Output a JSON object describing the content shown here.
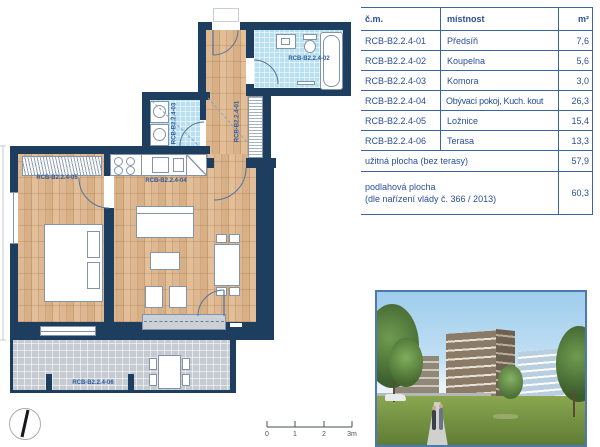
{
  "table": {
    "headers": {
      "code": "č.m.",
      "room": "místnost",
      "area": "m²"
    },
    "rows": [
      {
        "code": "RCB-B2.2.4-01",
        "room": "Předsíň",
        "area": "7,6"
      },
      {
        "code": "RCB-B2.2.4-02",
        "room": "Koupelna",
        "area": "5,6"
      },
      {
        "code": "RCB-B2.2.4-03",
        "room": "Komora",
        "area": "3,0"
      },
      {
        "code": "RCB-B2.2.4-04",
        "room": "Obývací pokoj, Kuch. kout",
        "area": "26,3"
      },
      {
        "code": "RCB-B2.2.4-05",
        "room": "Ložnice",
        "area": "15,4"
      },
      {
        "code": "RCB-B2.2.4-06",
        "room": "Terasa",
        "area": "13,3"
      }
    ],
    "summary1": {
      "label": "užitná plocha (bez terasy)",
      "area": "57,9"
    },
    "summary2": {
      "label": "podlahová plocha",
      "label2": "(dle nařízení vlády č. 366 / 2013)",
      "area": "60,3"
    }
  },
  "plan": {
    "labels": {
      "hall": "RCB-B2.2.4-01",
      "bath": "RCB-B2.2.4-02",
      "storage": "RCB-B2.2.4-03",
      "living": "RCB-B2.2.4-04",
      "bedroom": "RCB-B2.2.4-05",
      "terrace": "RCB-B2.2.4-06"
    },
    "scale_ticks": [
      "0",
      "1",
      "2",
      "3m"
    ]
  },
  "icons": {
    "compass": "north-arrow-icon"
  },
  "colors": {
    "wall": "#1d3e5f",
    "wood_floor": "#d9b38c",
    "bath_floor": "#b9e0f0",
    "terrace_floor": "#c6cbd1",
    "accent_text": "#2d5a9e",
    "table_line": "#3a63a8",
    "photo_border": "#4d79b0"
  }
}
